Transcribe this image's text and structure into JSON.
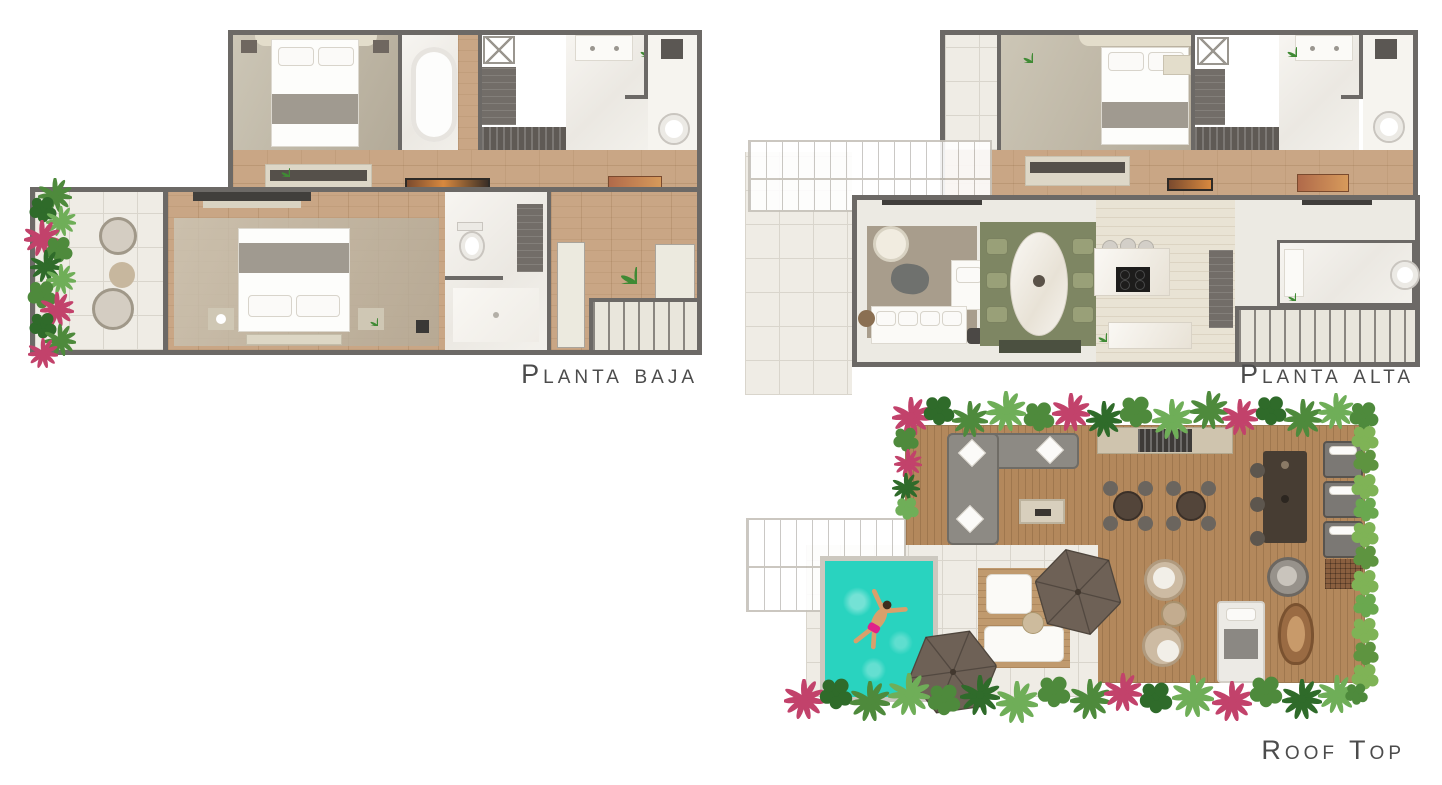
{
  "sheet": {
    "title": "Floor plan sheet"
  },
  "plans": [
    {
      "id": "planta-baja",
      "label": "Planta baja"
    },
    {
      "id": "planta-alta",
      "label": "Planta alta"
    },
    {
      "id": "roof-top",
      "label": "Roof Top"
    }
  ],
  "icons": {
    "swimmer": "swimmer-person",
    "umbrella": "hexagonal-parasol",
    "plants": "tropical-bushes"
  },
  "colors": {
    "wall": "#6c6966",
    "wood": "#c9a685",
    "deck": "#b3885c",
    "tile": "#efece5",
    "marble": "#f4f2ed",
    "rug_living": "#a89d8c",
    "rug_dining": "#7e8663",
    "pool": "#29d3bf",
    "pool_rim": "#ccc8bf",
    "plant_green": "#4e8a3c",
    "plant_light": "#6fae58",
    "plant_dark": "#2f6b2a",
    "plant_pink": "#c2426b",
    "hedge": "#7fb356",
    "umbrella": "#6e6156",
    "sofa_gray": "#8d8a84",
    "label": "#4c4c4c"
  }
}
